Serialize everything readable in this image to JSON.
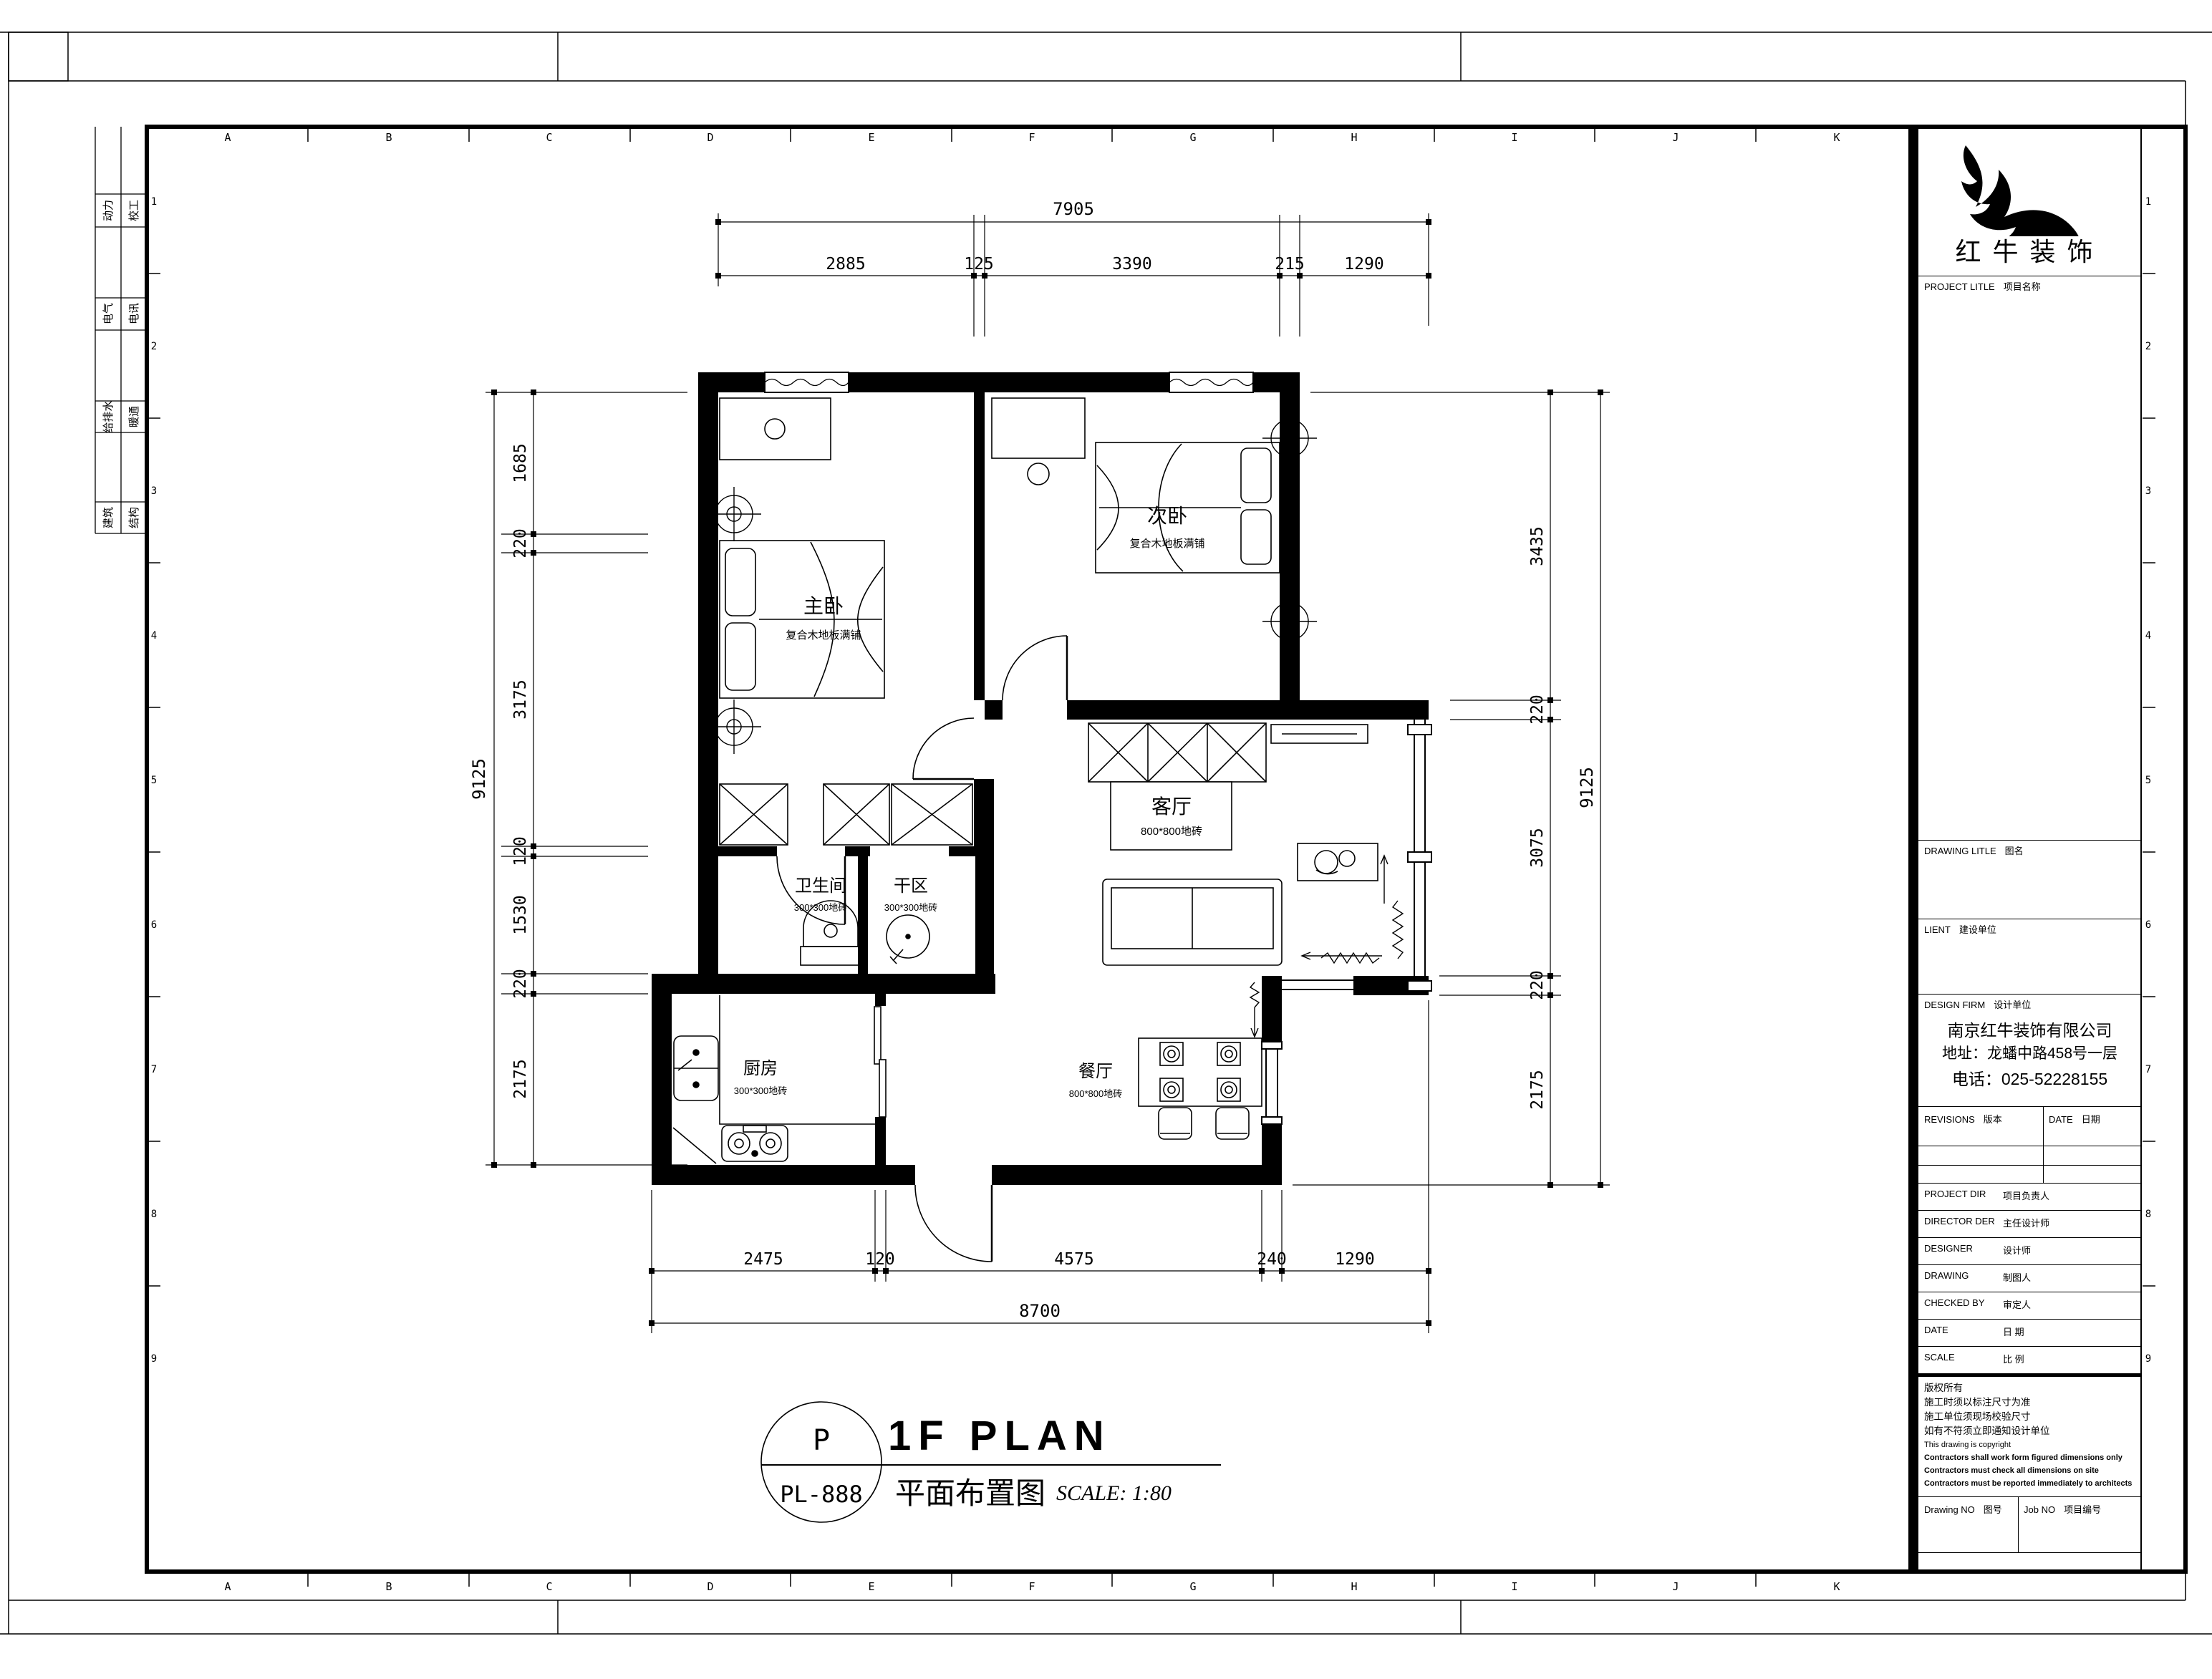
{
  "sheet": {
    "grid_letters": [
      "A",
      "B",
      "C",
      "D",
      "E",
      "F",
      "G",
      "H",
      "I",
      "J",
      "K"
    ],
    "row_numbers": [
      "1",
      "2",
      "3",
      "4",
      "5",
      "6",
      "7",
      "8",
      "9"
    ]
  },
  "stamp_table": {
    "col1": [
      "动力",
      "电气",
      "给排水",
      "建筑"
    ],
    "col2": [
      "校工",
      "电讯",
      "暖通",
      "结构"
    ]
  },
  "title_block": {
    "company_logo_text": "红牛装饰",
    "project_title_en": "PROJECT LITLE",
    "project_title_cn": "项目名称",
    "drawing_title_en": "DRAWING LITLE",
    "drawing_title_cn": "图名",
    "client_en": "LIENT",
    "client_cn": "建设单位",
    "design_firm_en": "DESIGN FIRM",
    "design_firm_cn": "设计单位",
    "firm_name": "南京红牛装饰有限公司",
    "firm_address": "地址：龙蟠中路458号一层",
    "firm_phone": "电话：025-52228155",
    "revisions_en": "REVISIONS",
    "revisions_cn": "版本",
    "date_col_en": "DATE",
    "date_col_cn": "日期",
    "staff_rows": [
      {
        "en": "PROJECT DIR",
        "cn": "项目负责人"
      },
      {
        "en": "DIRECTOR DER",
        "cn": "主任设计师"
      },
      {
        "en": "DESIGNER",
        "cn": "设计师"
      },
      {
        "en": "DRAWING",
        "cn": "制图人"
      },
      {
        "en": "CHECKED BY",
        "cn": "审定人"
      },
      {
        "en": "DATE",
        "cn": "日  期"
      },
      {
        "en": "SCALE",
        "cn": "比  例"
      }
    ],
    "notes": [
      "版权所有",
      "施工时须以标注尺寸为准",
      "施工单位须现场校验尺寸",
      "如有不符须立即通知设计单位",
      "This drawing is copyright",
      "Contractors shall work form figured dimensions only",
      "Contractors must check all dimensions on site",
      "Contractors must be reported immediately to architects"
    ],
    "drawing_no_en": "Drawing NO",
    "drawing_no_cn": "图号",
    "job_no_en": "Job NO",
    "job_no_cn": "项目编号"
  },
  "plan": {
    "rooms": {
      "master": {
        "name": "主卧",
        "finish": "复合木地板满铺"
      },
      "second": {
        "name": "次卧",
        "finish": "复合木地板满铺"
      },
      "living": {
        "name": "客厅",
        "finish": "800*800地砖"
      },
      "bath": {
        "name": "卫生间",
        "finish": "300*300地砖"
      },
      "dry": {
        "name": "干区",
        "finish": "300*300地砖"
      },
      "kitchen": {
        "name": "厨房",
        "finish": "300*300地砖"
      },
      "dining": {
        "name": "餐厅",
        "finish": "800*800地砖"
      }
    },
    "dims": {
      "top": {
        "total": "7905",
        "segments": [
          "2885",
          "125",
          "3390",
          "215",
          "1290"
        ]
      },
      "left": {
        "total": "9125",
        "segments": [
          "1685",
          "220",
          "3175",
          "120",
          "1530",
          "220",
          "2175"
        ]
      },
      "right": {
        "total": "9125",
        "segments": [
          "3435",
          "220",
          "3075",
          "220",
          "2175"
        ]
      },
      "bottom": {
        "total": "8700",
        "segments": [
          "2475",
          "120",
          "4575",
          "240",
          "1290"
        ]
      }
    },
    "title": {
      "tag_top": "P",
      "tag_bottom": "PL-888",
      "name_en": "1F PLAN",
      "name_cn": "平面布置图",
      "scale": "SCALE: 1:80"
    }
  }
}
